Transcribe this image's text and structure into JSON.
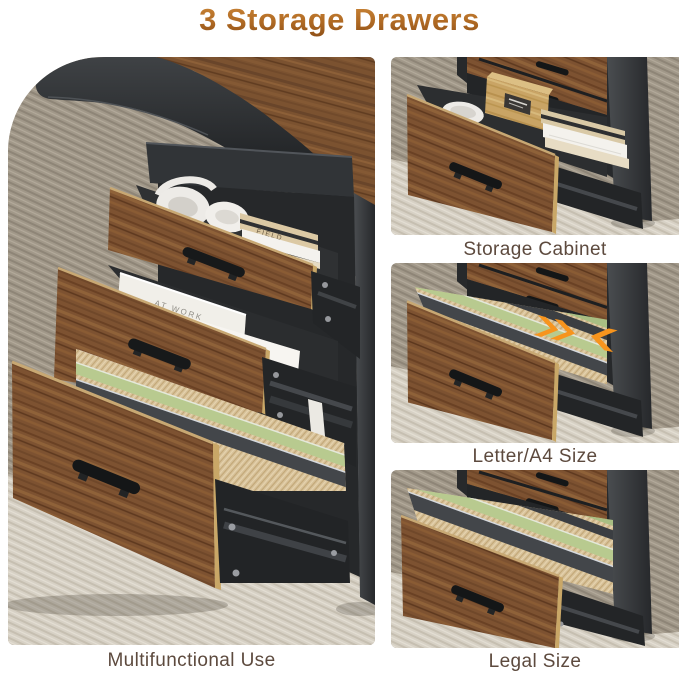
{
  "title": "3 Storage Drawers",
  "panels": [
    {
      "name": "multifunctional-use",
      "caption": "Multifunctional Use"
    },
    {
      "name": "storage-cabinet",
      "caption": "Storage Cabinet"
    },
    {
      "name": "letter-a4-size",
      "caption": "Letter/A4 Size"
    },
    {
      "name": "legal-size",
      "caption": "Legal Size"
    }
  ],
  "photo_texts": {
    "notebook_spine": "FIELD",
    "book_cover": "AT WORK"
  },
  "icons": {
    "size_adjust": "size-adjust-arrows-icon"
  },
  "colors": {
    "title_gradient_top": "#cf8a3a",
    "title_gradient_bottom": "#8a4d16",
    "caption_text": "#5d4a3e",
    "walnut_wood": "#7d5231",
    "light_wood_edge": "#c9a767",
    "black_frame": "#232527",
    "carpet_dark": "#a19889",
    "carpet_light": "#d7d1c5",
    "folder_tan": "#d8c29b",
    "folder_green": "#b8ca8f",
    "folder_gray": "#43464a",
    "arrow_orange": "#f7941d"
  }
}
